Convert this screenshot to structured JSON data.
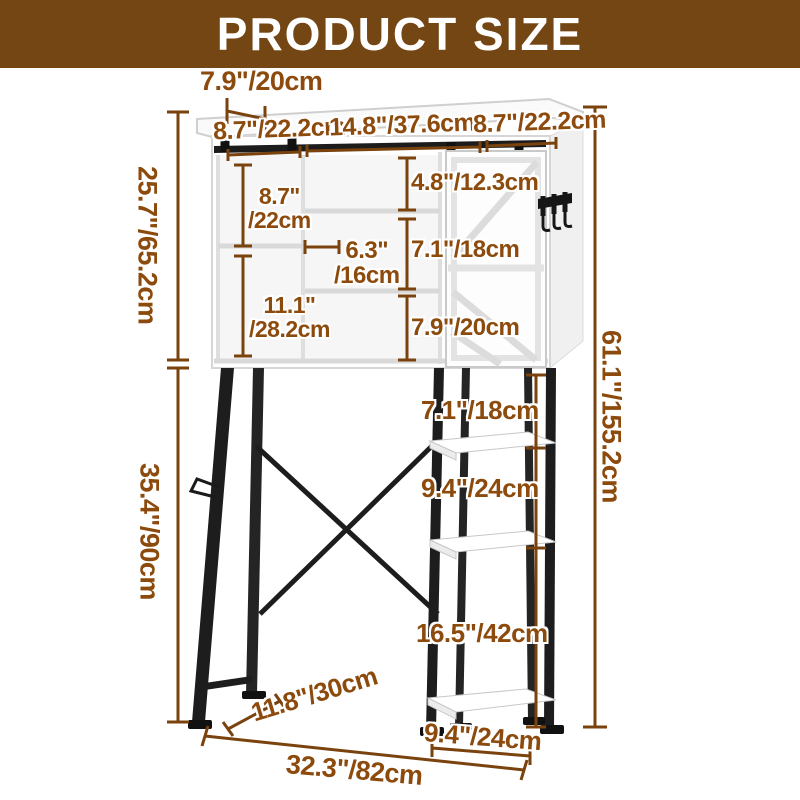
{
  "header": {
    "title": "PRODUCT SIZE"
  },
  "colors": {
    "header_bg": "#744614",
    "dimension_text": "#8c4a0c",
    "dimension_line": "#7a430e",
    "frame_black": "#1d1d1d",
    "cabinet_white": "#ffffff"
  },
  "dimensions": {
    "top_depth": "7.9\"/20cm",
    "top_width_left": "8.7\"/22.2cm",
    "top_width_middle": "14.8\"/37.6cm",
    "top_width_right": "8.7\"/22.2cm",
    "cabinet_height": "25.7\"/65.2cm",
    "upper_left_cubby_in": "8.7\"",
    "upper_left_cubby_cm": "/22cm",
    "upper_middle_cubby": "4.8\"/12.3cm",
    "middle_cubby_width_in": "6.3\"",
    "middle_cubby_width_cm": "/16cm",
    "middle_cubby_height": "7.1\"/18cm",
    "lower_left_cubby_in": "11.1\"",
    "lower_left_cubby_cm": "/28.2cm",
    "lower_middle_cubby": "7.9\"/20cm",
    "total_height": "61.1\"/155.2cm",
    "stand_gap_top": "7.1\"/18cm",
    "stand_gap_middle": "9.4\"/24cm",
    "stand_height": "35.4\"/90cm",
    "stand_gap_bottom": "16.5\"/42cm",
    "stand_depth": "11.8\"/30cm",
    "stand_shelf_width": "9.4\"/24cm",
    "total_width": "32.3\"/82cm"
  }
}
